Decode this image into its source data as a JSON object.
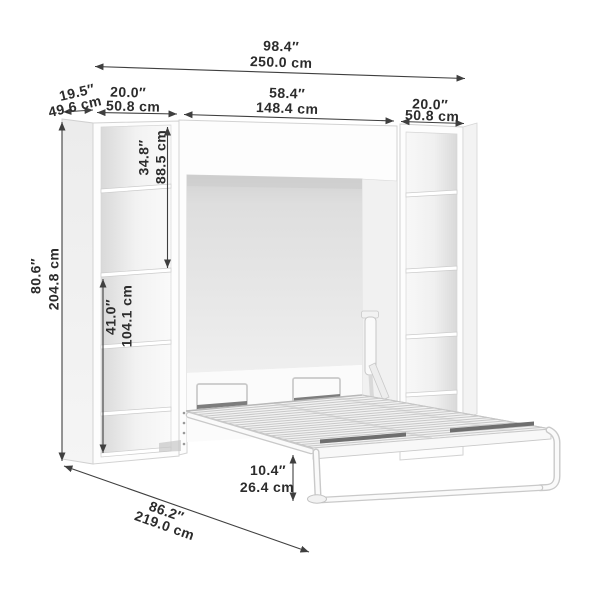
{
  "page": {
    "background": "#ffffff"
  },
  "annotation_style": {
    "line_color": "#3f3f3f",
    "text_color": "#2c2c2c"
  },
  "dimensions": {
    "overall_width": {
      "in": "98.4″",
      "cm": "250.0 cm"
    },
    "side_unit_depth": {
      "in": "19.5″",
      "cm": "49.6 cm"
    },
    "left_unit_width": {
      "in": "20.0″",
      "cm": "50.8 cm"
    },
    "bed_unit_width": {
      "in": "58.4″",
      "cm": "148.4 cm"
    },
    "right_unit_width": {
      "in": "20.0″",
      "cm": "50.8 cm"
    },
    "overall_height": {
      "in": "80.6″",
      "cm": "204.8 cm"
    },
    "upper_shelf_section_height": {
      "in": "34.8″",
      "cm": "88.5 cm"
    },
    "lower_shelf_section_height": {
      "in": "41.0″",
      "cm": "104.1 cm"
    },
    "open_bed_depth": {
      "in": "86.2″",
      "cm": "219.0 cm"
    },
    "bed_frame_height": {
      "in": "10.4″",
      "cm": "26.4 cm"
    }
  }
}
